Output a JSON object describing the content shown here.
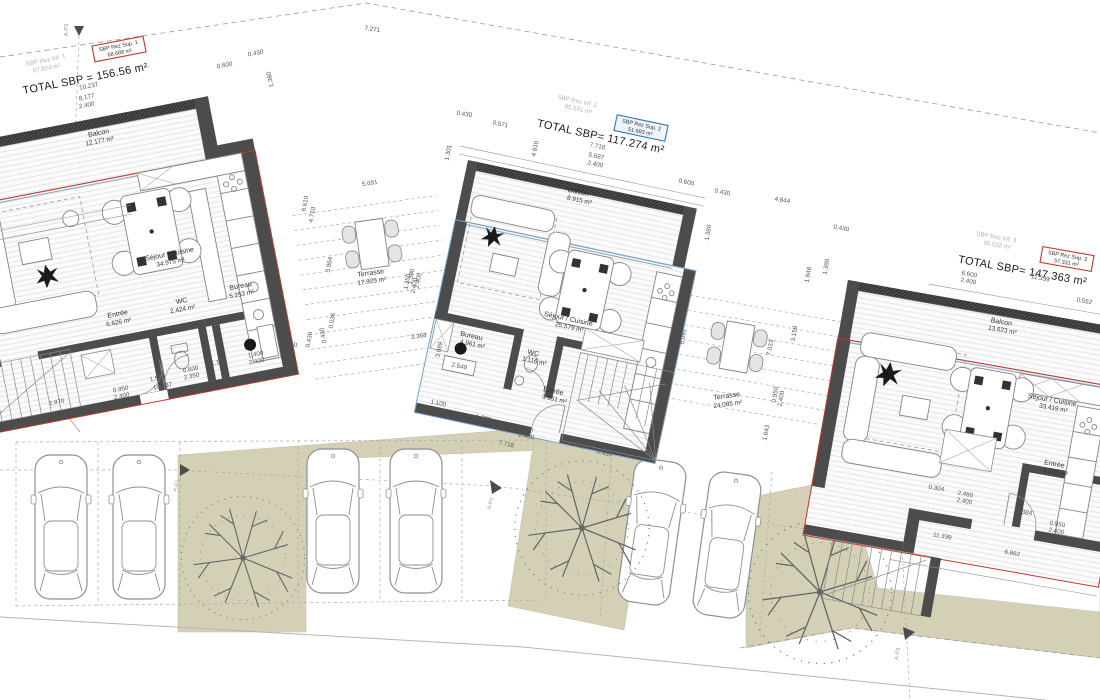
{
  "buildings": [
    {
      "name": "villa-1",
      "inf_label": "SBP Rez Inf. 1",
      "inf_area": "87.874 m²",
      "sup_label": "SBP Rez Sup. 1",
      "sup_area": "68.688 m²",
      "total": "TOTAL SBP = 156.56 m²",
      "rooms": [
        {
          "name": "Balcon",
          "area": "12.177 m²"
        },
        {
          "name": "Séjour / Cuisine",
          "area": "34.975 m²"
        },
        {
          "name": "WC",
          "area": "2.424 m²"
        },
        {
          "name": "Bureau",
          "area": "5.253 m²"
        },
        {
          "name": "Entrée",
          "area": "6.626 m²"
        },
        {
          "name": "Terrasse",
          "area": "17.925 m²"
        }
      ]
    },
    {
      "name": "villa-2",
      "inf_label": "SBP Rez Inf. 2",
      "inf_area": "65.591 m²",
      "sup_label": "SBP Rez Sup. 2",
      "sup_area": "51.683 m²",
      "total": "TOTAL SBP= 117.274 m²",
      "rooms": [
        {
          "name": "Balcon",
          "area": "8.915 m²"
        },
        {
          "name": "Séjour / Cuisine",
          "area": "25.579 m²"
        },
        {
          "name": "Bureau",
          "area": "4.961 m²"
        },
        {
          "name": "WC",
          "area": "1.116 m²"
        },
        {
          "name": "Entrée",
          "area": "3.951 m²"
        },
        {
          "name": "Terrasse",
          "area": "24.085 m²"
        }
      ]
    },
    {
      "name": "villa-3",
      "inf_label": "SBP Rez Inf. 3",
      "inf_area": "90.032 m²",
      "sup_label": "SBP Rez Sup. 3",
      "sup_area": "57.331 m²",
      "total": "TOTAL SBP= 147.363 m²",
      "rooms": [
        {
          "name": "Balcon",
          "area": "13.623 m²"
        },
        {
          "name": "Séjour / Cuisine",
          "area": "33.419 m²"
        },
        {
          "name": "Entrée",
          "area": "3.520 m²"
        }
      ]
    }
  ],
  "site": {
    "markers": {
      "p1": "A-P1",
      "p2": "A-P2",
      "p3": "A-P3"
    }
  },
  "colors": {
    "accent_red": "#c0392b",
    "accent_blue": "#2e75b6",
    "wall": "#4c4c4c",
    "lawn": "#d3d0b5"
  },
  "dims": [
    "0.600",
    "0.430",
    "10.237",
    "8.177",
    "2.400",
    "1.380",
    "7.271",
    "0.430",
    "0.571",
    "7.718",
    "5.687",
    "2.400",
    "0.600",
    "0.430",
    "4.810",
    "1.301",
    "4.844",
    "0.430",
    "1.380",
    "1.846",
    "1.380",
    "6.600",
    "2.400",
    "11.339",
    "0.552",
    "2.970",
    "0.950",
    "2.400",
    "1.556",
    "10.237",
    "0.600",
    "2.350",
    "1.100",
    "1.400",
    "2.400",
    "0.800",
    "0.430",
    "5.691",
    "8.610",
    "4.710",
    "3.964",
    "1.350",
    "2.400",
    "0.536",
    "3.368",
    "0.430",
    "3.089",
    "2.549",
    "1.100",
    "1.000",
    "1.798",
    "0.950",
    "2.400",
    "7.718",
    "2.410",
    "0.430",
    "6.770",
    "8.092",
    "7.033",
    "3.159",
    "0.950",
    "2.400",
    "1.643",
    "0.304",
    "2.480",
    "2.400",
    "0.430",
    "1.384",
    "0.950",
    "2.400",
    "11.339",
    "6.862",
    "1.390",
    "2.400"
  ]
}
